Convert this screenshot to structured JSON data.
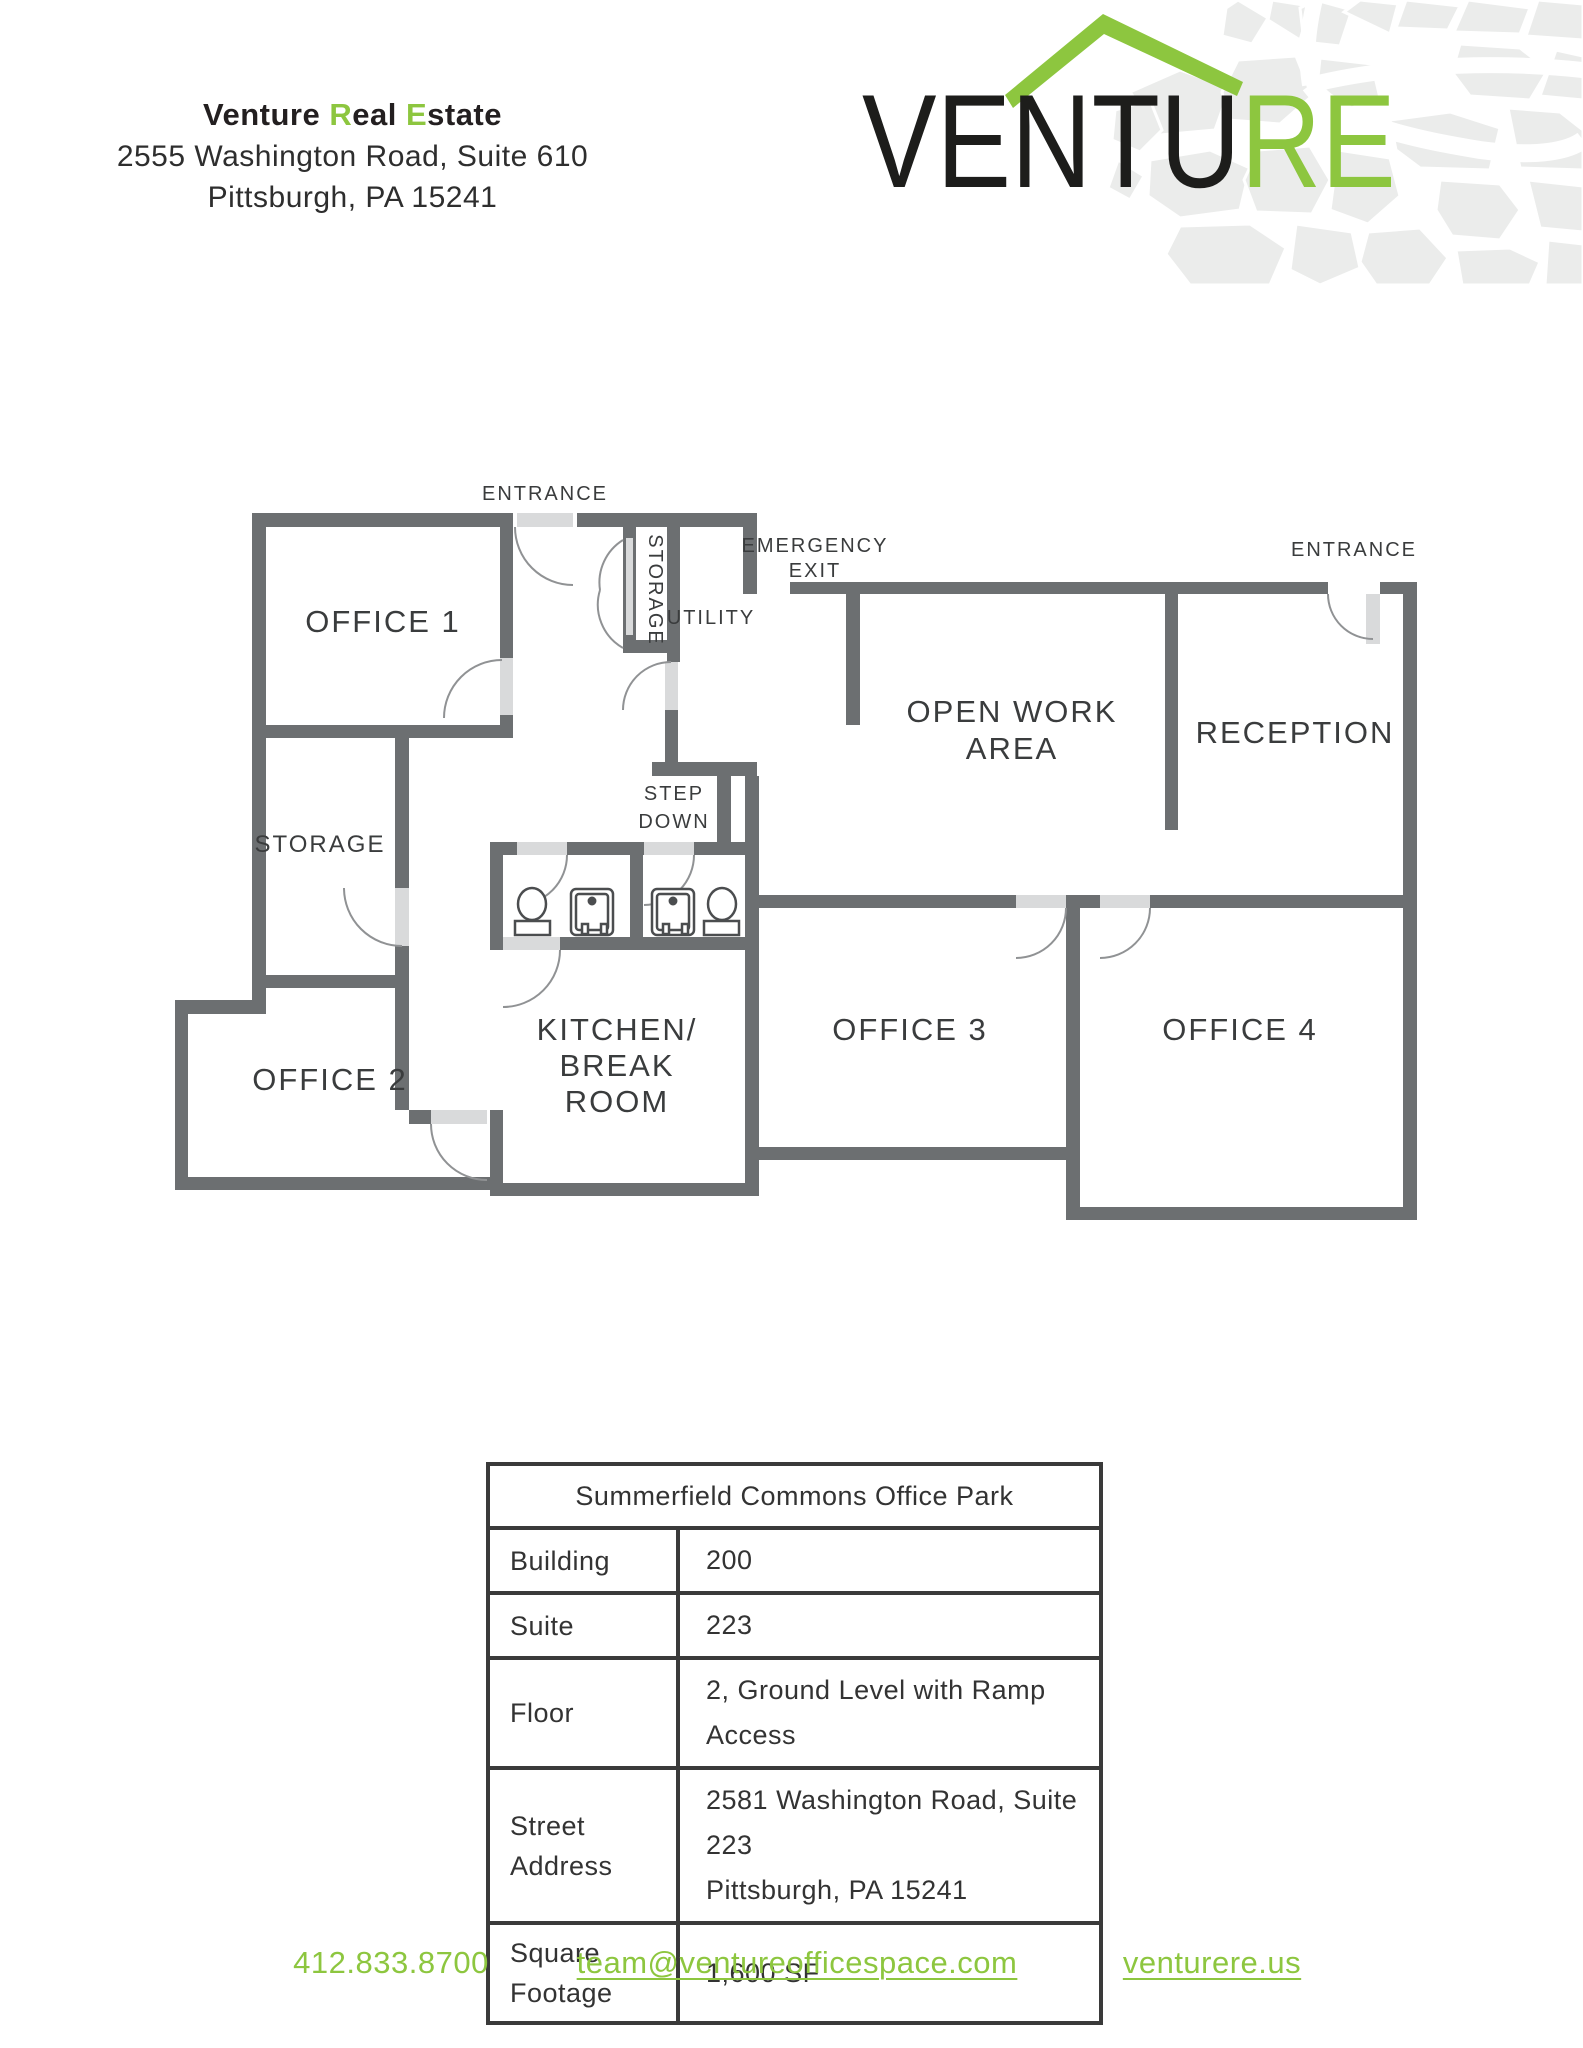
{
  "colors": {
    "accent_green": "#8dc63f",
    "wall_gray": "#6c6f71",
    "door_leaf_gray": "#d9dadb"
  },
  "header": {
    "company_part1": "Venture ",
    "company_part2": "R",
    "company_part3": "eal ",
    "company_part4": "E",
    "company_part5": "state",
    "address_line1": "2555 Washington Road, Suite 610",
    "address_line2": "Pittsburgh, PA 15241"
  },
  "logo": {
    "black_text": "VENTU",
    "green_text": "RE"
  },
  "floor_plan": {
    "entrance_top": "ENTRANCE",
    "entrance_right": "ENTRANCE",
    "emergency_line1": "EMERGENCY",
    "emergency_line2": "EXIT",
    "step_down_line1": "STEP",
    "step_down_line2": "DOWN",
    "storage_closet": "STORAGE",
    "storage_room": "STORAGE",
    "utility": "UTILITY",
    "office1": "OFFICE 1",
    "office2": "OFFICE 2",
    "office3": "OFFICE 3",
    "office4": "OFFICE 4",
    "open_work_line1": "OPEN WORK",
    "open_work_line2": "AREA",
    "reception": "RECEPTION",
    "kitchen_line1": "KITCHEN/",
    "kitchen_line2": "BREAK",
    "kitchen_line3": "ROOM"
  },
  "details_table": {
    "title": "Summerfield Commons Office Park",
    "rows": [
      {
        "label": "Building",
        "value": "200"
      },
      {
        "label": "Suite",
        "value": "223"
      },
      {
        "label": "Floor",
        "value": "2, Ground Level with Ramp Access"
      },
      {
        "label": "Street Address",
        "value": "2581 Washington Road, Suite 223\nPittsburgh, PA 15241"
      },
      {
        "label": "Square Footage",
        "value": "1,600 SF"
      }
    ]
  },
  "footer": {
    "phone": "412.833.8700",
    "email": "team@ventureofficespace.com",
    "website": "venturere.us"
  }
}
